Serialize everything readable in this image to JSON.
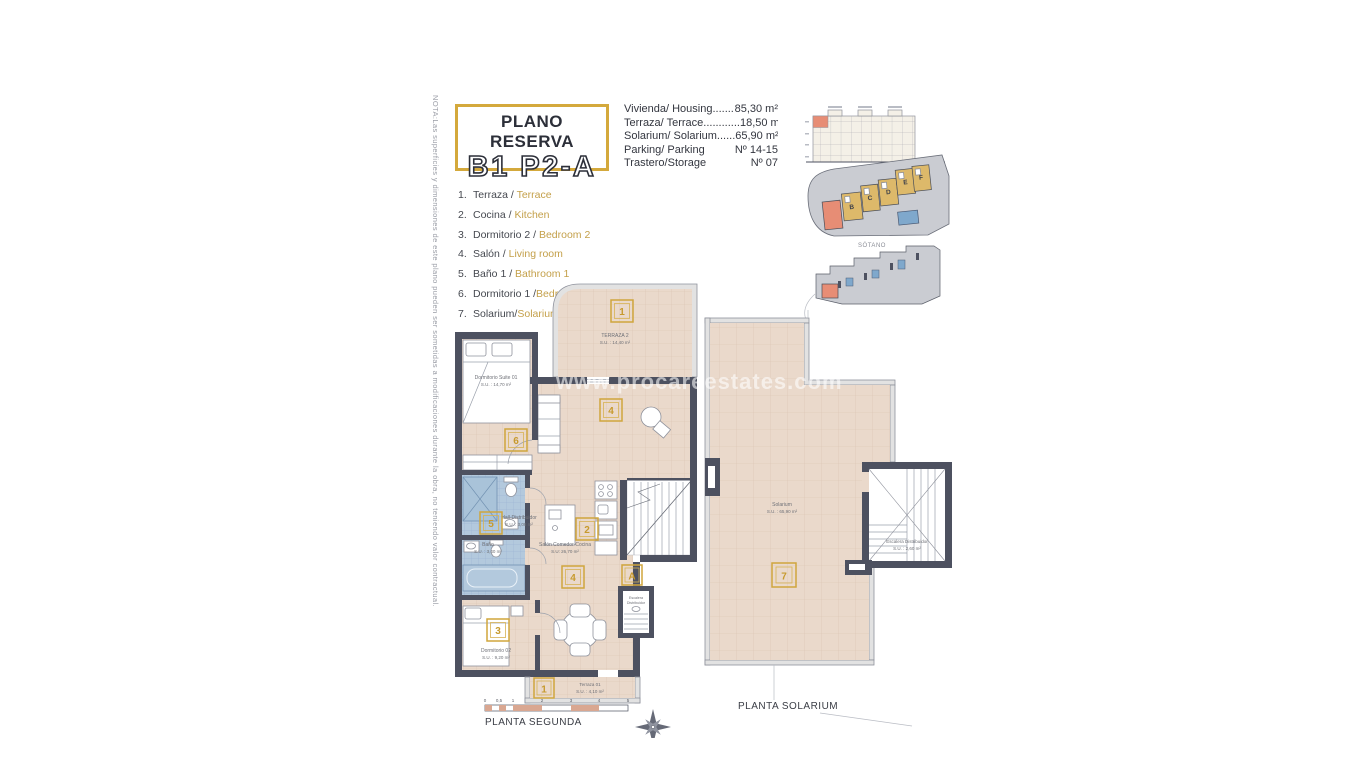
{
  "note": "NOTA:Las superficies y dimensiones de este plano pueden ser sometidas a modificaciones durante la obra, no teniendo valor contractual.",
  "title": {
    "line1": "PLANO RESERVA",
    "line2": "B1 P2-A"
  },
  "specs": {
    "rows": [
      {
        "label": "Vivienda/ Housing.......",
        "value": "85,30 m²"
      },
      {
        "label": "Terraza/ Terrace............",
        "value": "18,50 m²"
      },
      {
        "label": "Solarium/ Solarium......",
        "value": "65,90 m²"
      },
      {
        "label": "Parking/ Parking",
        "value": "Nº 14-15"
      },
      {
        "label": "Trastero/Storage",
        "value": "Nº 07"
      }
    ]
  },
  "legend": {
    "items": [
      {
        "num": "1.",
        "es": "Terraza / ",
        "en": "Terrace"
      },
      {
        "num": "2.",
        "es": "Cocina / ",
        "en": "Kitchen"
      },
      {
        "num": "3.",
        "es": "Dormitorio 2 / ",
        "en": "Bedroom 2"
      },
      {
        "num": "4.",
        "es": "Salón / ",
        "en": "Living room"
      },
      {
        "num": "5.",
        "es": "Baño 1 / ",
        "en": "Bathroom 1"
      },
      {
        "num": "6.",
        "es": "Dormitorio 1 /",
        "en": "Bedroom 1"
      },
      {
        "num": "7.",
        "es": "Solarium/",
        "en": "Solarium"
      }
    ]
  },
  "minimaps": {
    "sotano_label": "SÓTANO",
    "blocks": {
      "b": "B",
      "c": "C",
      "d": "D",
      "e": "E",
      "f": "F"
    }
  },
  "plan_segunda": {
    "caption": "PLANTA SEGUNDA",
    "scale": {
      "t0": "0",
      "t05": "0,5",
      "t1": "1",
      "t2": "2",
      "t3": "3",
      "t4": "4",
      "t5": "5"
    },
    "labels": {
      "terraza2": {
        "num": "1",
        "name": "TERRAZA 2",
        "area": "S.U. : 14,40 m²"
      },
      "dormitorio1": {
        "num": "6",
        "name": "Dormitorio Suite 01",
        "area": "S.U. : 14,70 m²"
      },
      "bano": {
        "num": "5",
        "name": "Baño",
        "area": "S.U. : 3,40 m²"
      },
      "hall": {
        "name": "Hall-Distribuidor",
        "area": "S.U. : 3,08 m²"
      },
      "cocina": {
        "num": "2"
      },
      "salon": {
        "num": "4",
        "name": "Salón Comedor-Cocina",
        "area": "S.U: 26,70 m²"
      },
      "dormitorio2": {
        "num": "3",
        "name": "Dormitorio 02",
        "area": "S.U. : 9,20 m²"
      },
      "terraza1": {
        "num": "1",
        "name": "Terraza 01",
        "area": "S.U. : 4,10 m²"
      },
      "ascensor": {
        "num": "A"
      },
      "escalera": {
        "l1": "Escalera",
        "l2": "Distribuidor"
      }
    }
  },
  "plan_solarium": {
    "caption": "PLANTA SOLARIUM",
    "labels": {
      "solarium": {
        "num": "7",
        "name": "Solarium",
        "area": "S.U. : 65,90 m²"
      },
      "escalera": {
        "name": "Escalera Distribuidor",
        "area": "S.U. : 2,60 m²"
      }
    }
  },
  "watermark": "www.procareestates.com",
  "colors": {
    "accent_gold": "#d0a63c",
    "wall": "#4d5160",
    "floor": "#ead9cb",
    "tile_blue": "#b3c9dd",
    "highlight_salmon": "#e78d75",
    "block_tan": "#ddb96a"
  }
}
